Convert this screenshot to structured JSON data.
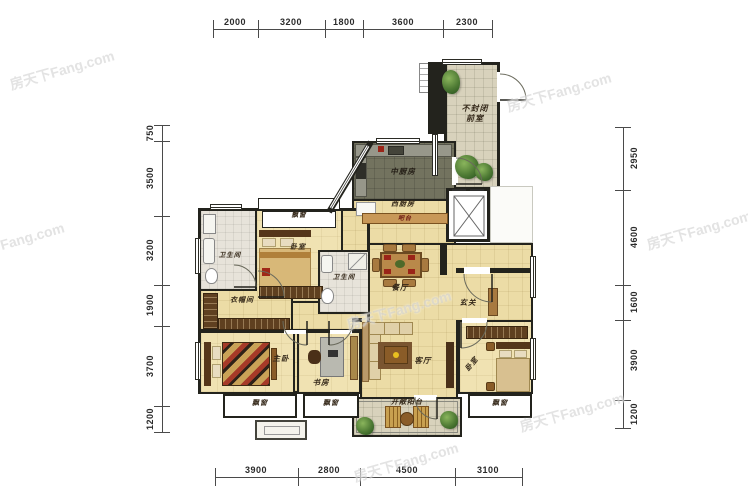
{
  "watermark": {
    "text": "房天下Fang.com"
  },
  "dims": {
    "top": [
      "2000",
      "3200",
      "1800",
      "3600",
      "2300"
    ],
    "bottom": [
      "3900",
      "2800",
      "4500",
      "3100"
    ],
    "left": [
      "750",
      "3500",
      "3200",
      "1900",
      "3700",
      "1200"
    ],
    "right": [
      "2950",
      "4600",
      "1600",
      "3900",
      "1200"
    ]
  },
  "rooms": {
    "front_room_line1": "不封闭",
    "front_room_line2": "前室",
    "kitchen_cn": "中厨房",
    "kitchen_west": "西厨房",
    "bar_counter": "吧台",
    "bathroom1": "卫生间",
    "bathroom2": "卫生间",
    "bedroom1": "卧室",
    "bay_window_n": "飘窗",
    "cloakroom": "衣帽间",
    "dining": "餐厅",
    "entry": "玄关",
    "master_bedroom": "主卧",
    "study": "书房",
    "living": "客厅",
    "balcony": "开敞阳台",
    "bedroom2": "卧室",
    "bay_window_sw": "飘窗",
    "bay_window_s": "飘窗",
    "bay_window_e": "飘窗"
  },
  "colors": {
    "wall": "#23231d",
    "floor_beige": "#ecdca6",
    "floor_tile": "#d8d2bc",
    "floor_kitchen": "#73735f",
    "wood": "#b9894a",
    "wood_dark": "#6b4a24",
    "accent_red": "#a02818",
    "plant_green": "#4e7a34"
  }
}
